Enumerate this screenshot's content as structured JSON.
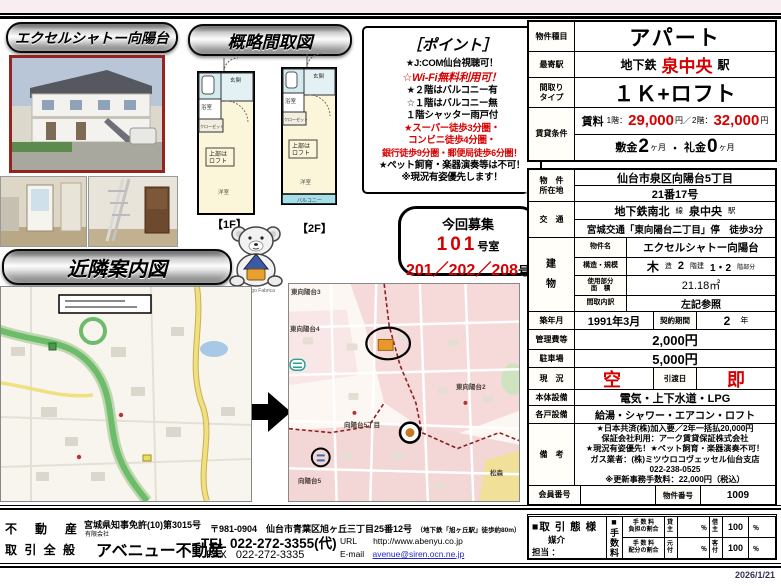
{
  "page": {
    "date": "2026/1/21"
  },
  "banners": {
    "property": "エクセルシャトー向陽台",
    "floorplan": "概略間取図",
    "map": "近隣案内図"
  },
  "points": {
    "title": "［ポイント］",
    "lines": [
      "★J:COM仙台視聴可！",
      "☆Wi-Fi無料利用可！",
      "★２階はバルコニー有",
      "☆１階はバルコニー無",
      "１階シャッター雨戸付",
      "★スーパー徒歩3分圏・",
      "コンビニ徒歩4分圏・",
      "銀行徒歩9分圏・郵便局徒歩6分圏！",
      "★ペット飼育・楽器演奏等は不可！",
      "※現況有姿優先します！"
    ]
  },
  "recruit": {
    "heading": "今回募集",
    "room1": "101",
    "room1_suffix": "号室",
    "room2": "201／202／208",
    "room2_suffix": "号"
  },
  "floorplan": {
    "f1": "【1F】",
    "f2": "【2F】",
    "loft1": "上部は",
    "loft2": "ロフト",
    "entrance": "玄関",
    "bath": "浴室",
    "closet": "クローゼット",
    "room": "洋室",
    "balcony": "バルコニー"
  },
  "mascot": {
    "credit": "© 2005 Mango Fabrica"
  },
  "maps": {
    "detail_labels": [
      "東向陽台3",
      "東向陽台4",
      "東向陽台2",
      "向陽台5丁目",
      "向陽台5",
      "松森"
    ]
  },
  "table": {
    "type_label": "物件種目",
    "type_value": "アパート",
    "station_label": "最寄駅",
    "station_pre": "地下鉄",
    "station_name": "泉中央",
    "station_suf": "駅",
    "layout_label1": "間取り",
    "layout_label2": "タイプ",
    "layout_value": "１Ｋ+ロフト",
    "terms_label": "賃貸条件",
    "rent_label": "賃料",
    "rent_f1_pre": "1階：",
    "rent_f1": "29,000",
    "rent_f1_suf": "円／",
    "rent_f2_pre": "2階：",
    "rent_f2": "32,000",
    "rent_f2_suf": "円",
    "deposit_pre": "敷金",
    "deposit_num": "2",
    "deposit_suf": "ヶ月",
    "sep": "・",
    "key_pre": "礼金",
    "key_num": "0",
    "key_suf": "ヶ月",
    "addr_label1": "物　件",
    "addr_label2": "所在地",
    "addr1": "仙台市泉区向陽台5丁目",
    "addr2": "21番17号",
    "access_label": "交　通",
    "access1_a": "地下鉄南北",
    "access1_b": "線",
    "access1_c": "泉中央",
    "access1_d": "駅",
    "access2": "宮城交通「東向陽台二丁目」停　徒歩3分",
    "bld_label1": "建",
    "bld_label2": "物",
    "bname_label": "物件名",
    "bname": "エクセルシャトー向陽台",
    "struct_label": "構造・規模",
    "struct_a": "木",
    "struct_b": "造",
    "struct_c": "2",
    "struct_d": "階建",
    "struct_e": "1・2",
    "struct_f": "階部分",
    "area_label1": "使用部分",
    "area_label2": "面　積",
    "area_value": "21.18㎡",
    "madori_label": "間取内訳",
    "madori_value": "左記参照",
    "built_label": "築年月",
    "built_value": "1991年3月",
    "contract_label": "契約期間",
    "contract_num": "2",
    "contract_unit": "年",
    "mgmt_label": "管理費等",
    "mgmt_value": "2,000円",
    "park_label": "駐車場",
    "park_value": "5,000円",
    "status_label": "現　況",
    "status_value": "空",
    "handover_label": "引渡日",
    "handover_value": "即",
    "base_label": "本体設備",
    "base_value": "電気・上下水道・LPG",
    "unit_label": "各戸設備",
    "unit_value": "給湯・シャワー・エアコン・ロフト",
    "notes_label": "備　考",
    "notes": [
      "★日本共済(株)加入要／2年一括払20,000円",
      "保証会社利用：アーク賃貸保証株式会社",
      "★現況有姿優先！★ペット飼育・楽器演奏不可！",
      "ガス業者：(株)ミツウロコヴェッセル仙台支店",
      "022-238-0525",
      "※更新事務手数料：22,000円（税込）"
    ],
    "member_label": "会員番号",
    "member_value": "",
    "bukken_label": "物件番号",
    "bukken_value": "1009"
  },
  "deal": {
    "style_label": "■取 引 態 様",
    "style_value": "媒介",
    "staff_label": "担当 ：",
    "fee_heading": "■手数料",
    "r1_label1": "手 数 料",
    "r1_label2": "負担の割合",
    "r1_a": "貸主",
    "r1_a_pct": "％",
    "r1_b": "借主",
    "r1_b_val": "100",
    "r1_b_pct": "％",
    "r2_label1": "手 数 料",
    "r2_label2": "配分の割合",
    "r2_a": "元付",
    "r2_a_pct": "％",
    "r2_b": "客付",
    "r2_b_val": "100",
    "r2_b_pct": "％"
  },
  "footer": {
    "biz1": "不　動　産",
    "biz2": "取 引 全 般",
    "license": "宮城県知事免許(10)第3015号",
    "corp_type": "有限会社",
    "company": "アベニュー不動産",
    "address": "〒981-0904　仙台市青葉区旭ヶ丘三丁目25番12号",
    "address_note": "（地下鉄「旭ヶ丘駅」徒歩約80m）",
    "tel_label": "TEL",
    "tel": "022-272-3355(代)",
    "fax_label": "FAX",
    "fax": "022-272-3335",
    "url_label": "URL",
    "url": "http://www.abenyu.co.jp",
    "email_label": "E-mail",
    "email": "avenue@siren.ocn.ne.jp"
  }
}
